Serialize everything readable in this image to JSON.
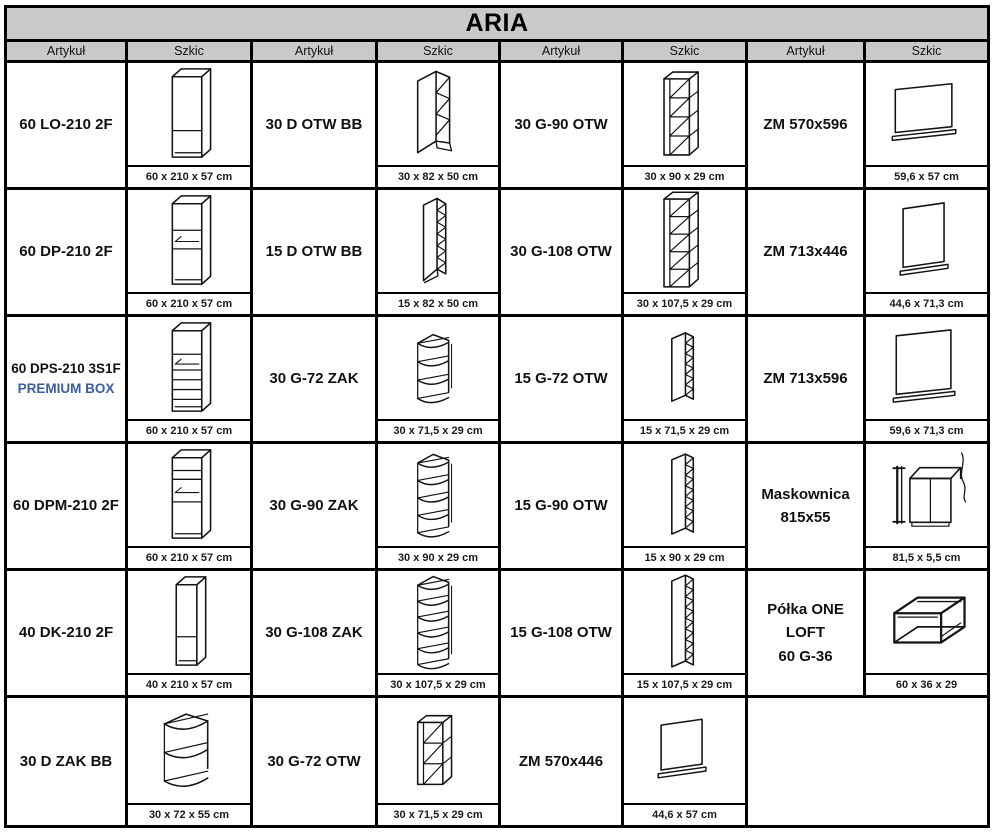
{
  "title": "ARIA",
  "column_headers": [
    "Artykuł",
    "Szkic",
    "Artykuł",
    "Szkic",
    "Artykuł",
    "Szkic",
    "Artykuł",
    "Szkic"
  ],
  "colors": {
    "header_bg": "#c9c9c9",
    "border": "#000000",
    "accent_blue": "#3a5da8",
    "text": "#111111"
  },
  "rows": [
    {
      "pairs": [
        {
          "article_lines": [
            "60 LO-210 2F"
          ],
          "sketch": "tall-lo",
          "sketch_name": "tall-cabinet-sketch",
          "dims": "60 x 210 x 57 cm"
        },
        {
          "article_lines": [
            "30 D OTW BB"
          ],
          "sketch": "base-otw-30",
          "sketch_name": "base-open-shelf-sketch",
          "dims": "30 x 82 x 50 cm"
        },
        {
          "article_lines": [
            "30 G-90 OTW"
          ],
          "sketch": "wall-otw-4",
          "sketch_name": "wall-open-shelf-sketch",
          "dims": "30 x 90 x 29 cm"
        },
        {
          "article_lines": [
            "ZM 570x596"
          ],
          "sketch": "panel-570x596",
          "sketch_name": "appliance-front-panel-sketch",
          "dims": "59,6 x 57 cm"
        }
      ]
    },
    {
      "pairs": [
        {
          "article_lines": [
            "60 DP-210 2F"
          ],
          "sketch": "tall-dp",
          "sketch_name": "tall-oven-cabinet-sketch",
          "dims": "60 x 210 x 57 cm"
        },
        {
          "article_lines": [
            "15 D OTW BB"
          ],
          "sketch": "base-otw-15",
          "sketch_name": "base-open-shelf-sketch",
          "dims": "15 x 82 x 50 cm"
        },
        {
          "article_lines": [
            "30 G-108 OTW"
          ],
          "sketch": "wall-otw-5",
          "sketch_name": "wall-open-shelf-sketch",
          "dims": "30 x 107,5 x 29 cm"
        },
        {
          "article_lines": [
            "ZM 713x446"
          ],
          "sketch": "panel-713x446",
          "sketch_name": "appliance-front-panel-sketch",
          "dims": "44,6 x 71,3 cm"
        }
      ]
    },
    {
      "pairs": [
        {
          "article_lines": [
            "60 DPS-210 3S1F",
            "PREMIUM BOX"
          ],
          "accent_line": 1,
          "compact": true,
          "sketch": "tall-dps",
          "sketch_name": "tall-oven-drawer-cabinet-sketch",
          "dims": "60 x 210 x 57 cm"
        },
        {
          "article_lines": [
            "30 G-72 ZAK"
          ],
          "sketch": "corner-zak-3",
          "sketch_name": "corner-shelf-sketch",
          "dims": "30 x 71,5 x 29 cm"
        },
        {
          "article_lines": [
            "15 G-72 OTW"
          ],
          "sketch": "narrow-otw-6",
          "sketch_name": "narrow-open-shelf-sketch",
          "dims": "15 x 71,5 x 29 cm"
        },
        {
          "article_lines": [
            "ZM 713x596"
          ],
          "sketch": "panel-713x596",
          "sketch_name": "appliance-front-panel-sketch",
          "dims": "59,6 x 71,3 cm"
        }
      ]
    },
    {
      "pairs": [
        {
          "article_lines": [
            "60 DPM-210 2F"
          ],
          "sketch": "tall-dpm",
          "sketch_name": "tall-microwave-cabinet-sketch",
          "dims": "60 x 210 x 57 cm"
        },
        {
          "article_lines": [
            "30 G-90 ZAK"
          ],
          "sketch": "corner-zak-4",
          "sketch_name": "corner-shelf-sketch",
          "dims": "30 x 90 x 29 cm"
        },
        {
          "article_lines": [
            "15 G-90 OTW"
          ],
          "sketch": "narrow-otw-7",
          "sketch_name": "narrow-open-shelf-sketch",
          "dims": "15 x 90 x 29 cm"
        },
        {
          "article_lines": [
            "Maskownica",
            "815x55"
          ],
          "sketch": "maskownica",
          "sketch_name": "cover-strip-sketch",
          "dims": "81,5 x 5,5 cm"
        }
      ]
    },
    {
      "pairs": [
        {
          "article_lines": [
            "40 DK-210 2F"
          ],
          "sketch": "tall-dk",
          "sketch_name": "tall-cabinet-sketch",
          "dims": "40 x 210 x 57 cm"
        },
        {
          "article_lines": [
            "30 G-108 ZAK"
          ],
          "sketch": "corner-zak-5",
          "sketch_name": "corner-shelf-sketch",
          "dims": "30 x 107,5 x 29 cm"
        },
        {
          "article_lines": [
            "15 G-108 OTW"
          ],
          "sketch": "narrow-otw-8",
          "sketch_name": "narrow-open-shelf-sketch",
          "dims": "15 x 107,5 x 29 cm"
        },
        {
          "article_lines": [
            "Półka ONE LOFT",
            "60 G-36"
          ],
          "sketch": "frame-shelf",
          "sketch_name": "metal-frame-shelf-sketch",
          "dims": "60 x 36 x 29"
        }
      ]
    },
    {
      "pairs": [
        {
          "article_lines": [
            "30 D ZAK BB"
          ],
          "sketch": "base-zak",
          "sketch_name": "corner-base-shelf-sketch",
          "dims": "30 x 72 x 55 cm"
        },
        {
          "article_lines": [
            "30 G-72 OTW"
          ],
          "sketch": "wall-otw-3",
          "sketch_name": "wall-open-shelf-sketch",
          "dims": "30 x 71,5 x 29 cm"
        },
        {
          "article_lines": [
            "ZM 570x446"
          ],
          "sketch": "panel-570x446",
          "sketch_name": "appliance-front-panel-sketch",
          "dims": "44,6 x 57 cm"
        },
        {
          "article_lines": [],
          "sketch": null,
          "sketch_name": null,
          "dims": null
        }
      ]
    }
  ]
}
